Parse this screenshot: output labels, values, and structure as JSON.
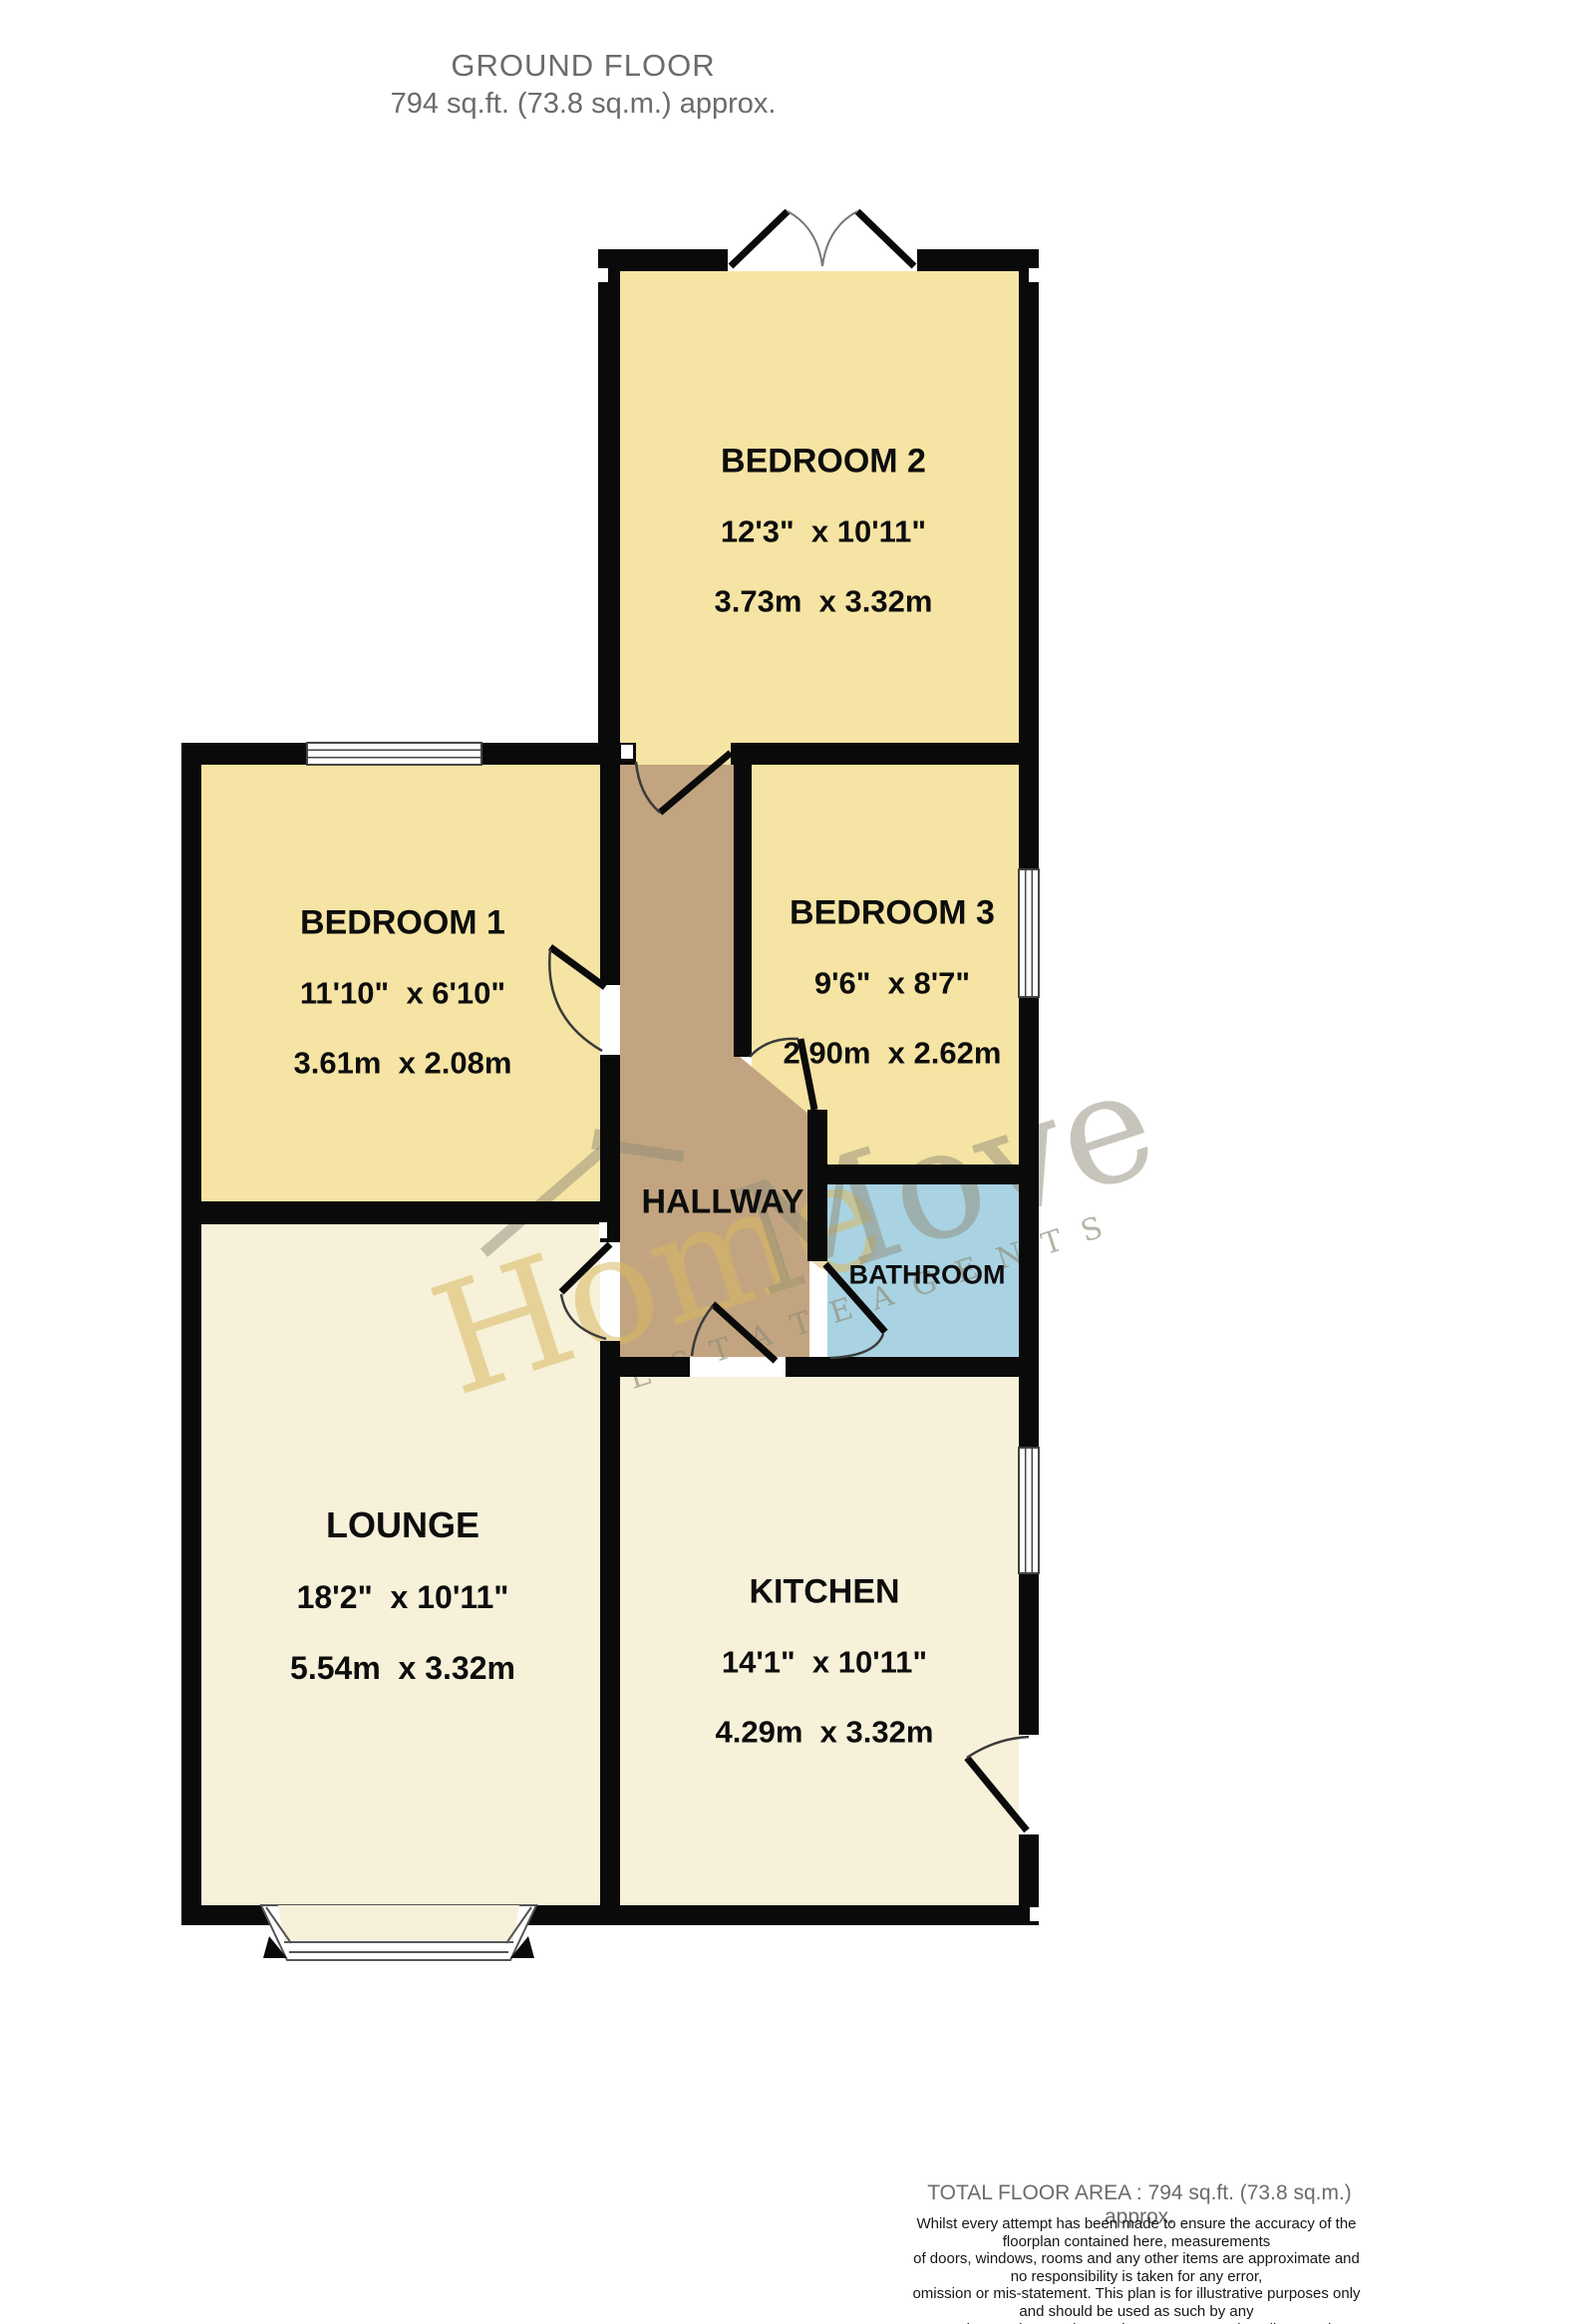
{
  "title": {
    "line1": "GROUND FLOOR",
    "line2": "794 sq.ft. (73.8 sq.m.) approx."
  },
  "rooms": [
    {
      "id": "bedroom2",
      "name": "BEDROOM 2",
      "dims_imperial": "12'3\"  x 10'11\"",
      "dims_metric": "3.73m  x 3.32m"
    },
    {
      "id": "bedroom1",
      "name": "BEDROOM 1",
      "dims_imperial": "11'10\"  x 6'10\"",
      "dims_metric": "3.61m  x 2.08m"
    },
    {
      "id": "bedroom3",
      "name": "BEDROOM 3",
      "dims_imperial": "9'6\"  x 8'7\"",
      "dims_metric": "2.90m  x 2.62m"
    },
    {
      "id": "hallway",
      "name": "HALLWAY"
    },
    {
      "id": "bathroom",
      "name": "BATHROOM"
    },
    {
      "id": "lounge",
      "name": "LOUNGE",
      "dims_imperial": "18'2\"  x 10'11\"",
      "dims_metric": "5.54m  x 3.32m"
    },
    {
      "id": "kitchen",
      "name": "KITCHEN",
      "dims_imperial": "14'1\"  x 10'11\"",
      "dims_metric": "4.29m  x 3.32m"
    }
  ],
  "watermark": {
    "word1": "Home",
    "word2": "Move",
    "caption": "E S T A T E    A G E N T S"
  },
  "footer": {
    "total_area": "TOTAL FLOOR AREA : 794 sq.ft. (73.8 sq.m.) approx.",
    "disclaimer_lines": [
      "Whilst every attempt has been made to ensure the accuracy of the floorplan contained here, measurements",
      "of doors, windows, rooms and any other items are approximate and no responsibility is taken for any error,",
      "omission or mis-statement. This plan is for illustrative purposes only and should be used as such by any",
      "prospective purchaser. The services, systems and appliances shown have not been tested and no guarantee",
      "as to their operability or efficiency can be given."
    ],
    "made_with": "Made with Metropix ©2026"
  },
  "colors": {
    "room_yellow": "#F6E4A4",
    "room_ivory": "#F7F1DA",
    "hallway_brown": "#C2A580",
    "bathroom_blue": "#A9D3E2",
    "wall_black": "#0A0A0A",
    "watermark_yellow": "#D9B860",
    "watermark_gray": "#8F8C78"
  }
}
